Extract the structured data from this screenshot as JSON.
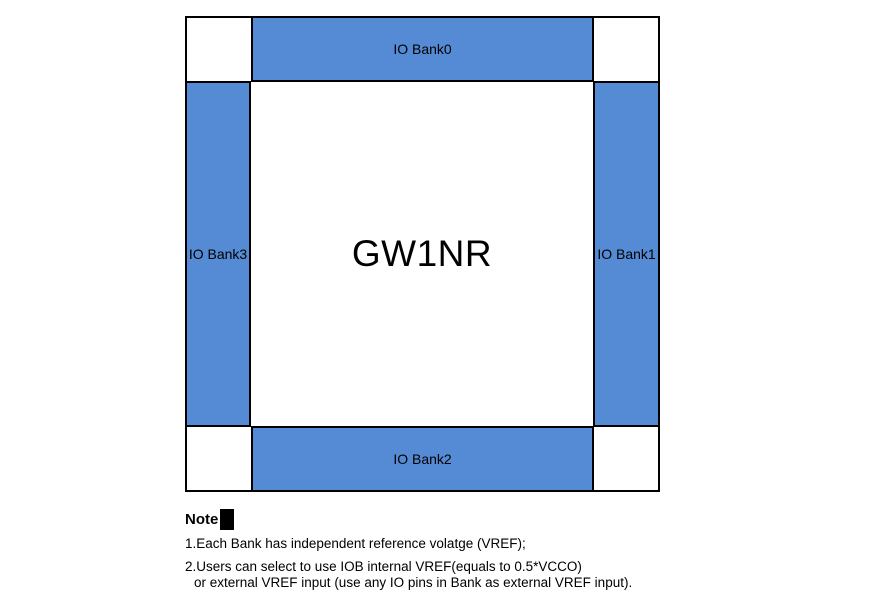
{
  "diagram": {
    "chip_label": "GW1NR",
    "banks": [
      {
        "label": "IO Bank0",
        "position": "top"
      },
      {
        "label": "IO Bank1",
        "position": "right"
      },
      {
        "label": "IO Bank2",
        "position": "bottom"
      },
      {
        "label": "IO Bank3",
        "position": "left"
      }
    ],
    "colors": {
      "bank_fill": "#548BD4",
      "border": "#000000",
      "background": "#ffffff"
    }
  },
  "note": {
    "title": "Note",
    "lines": [
      "1.Each Bank has independent reference volatge (VREF);",
      "2.Users can select to use IOB internal VREF(equals to 0.5*VCCO)",
      "or external VREF input (use any IO pins in Bank as external VREF input)."
    ]
  }
}
